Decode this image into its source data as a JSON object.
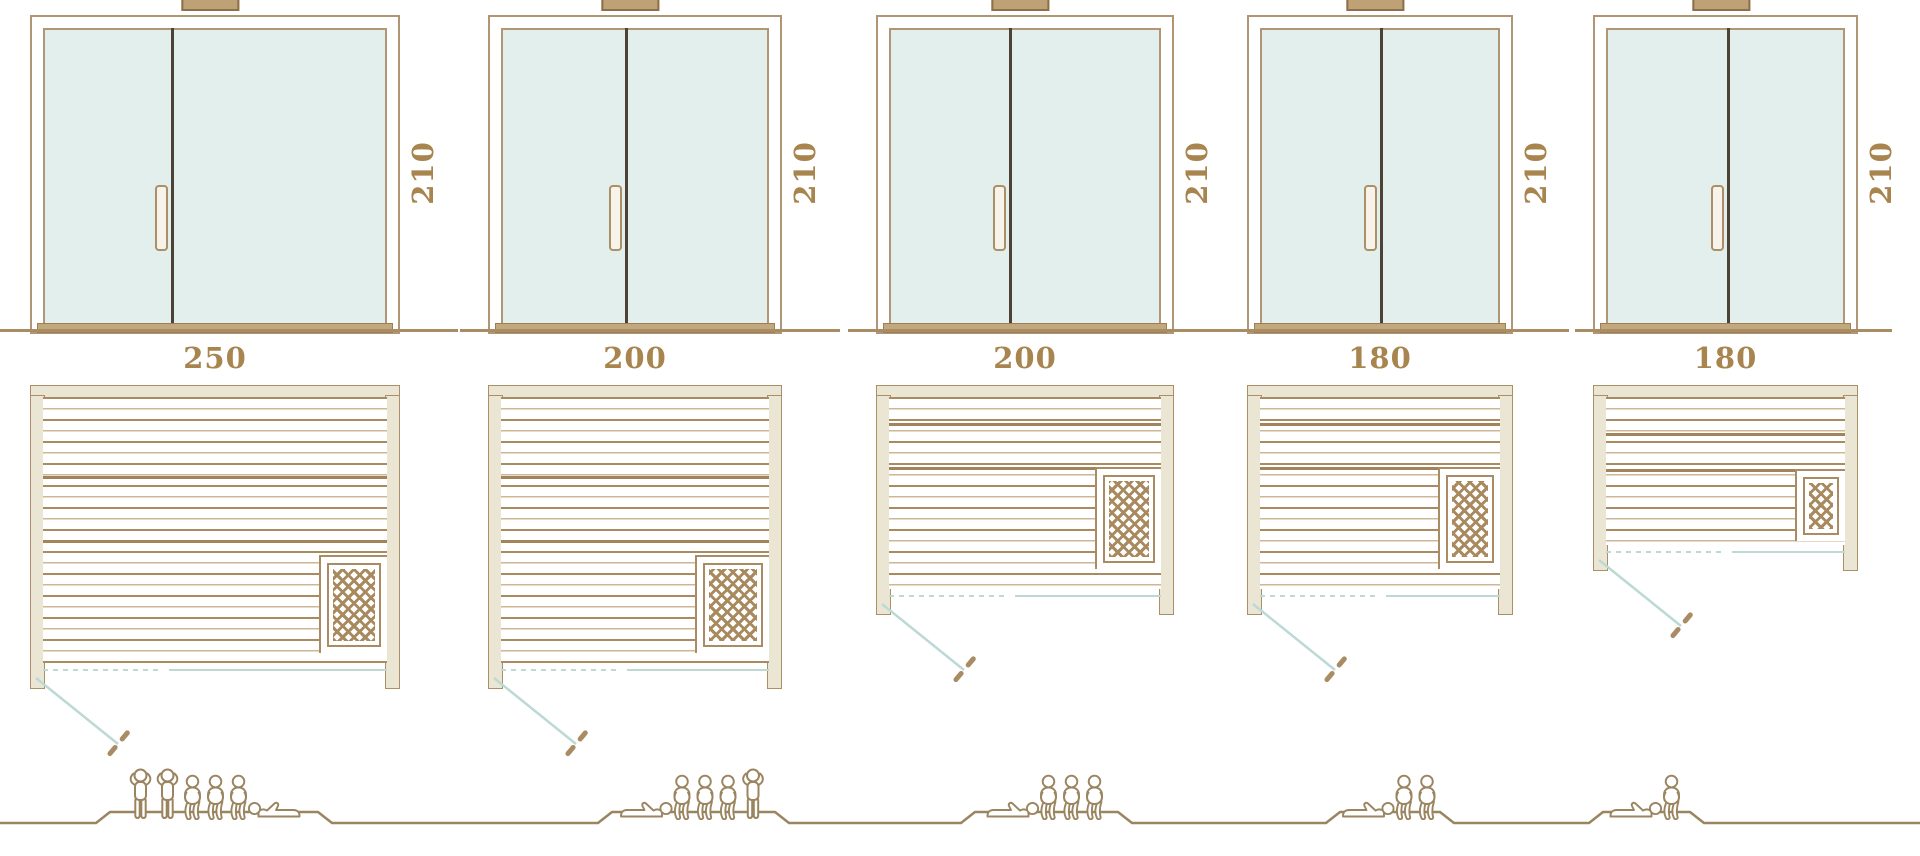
{
  "diagram": {
    "title": "Sauna size comparison — door elevations, floor plans and capacity"
  },
  "colors": {
    "frame_tan": "#b09674",
    "wall_beige": "#eae6d3",
    "glass": "#e2efec",
    "door_divider": "#4c4236",
    "dimension_text": "#a8854e",
    "slat_brown": "#a98b62",
    "swing_teal": "#bcd9d6",
    "figure_brown": "#9b8560"
  },
  "models": [
    {
      "door_height": "210",
      "width": "250",
      "depth": "200",
      "capacity": {
        "standing": 2,
        "sitting": 3,
        "lying": 1
      },
      "people": [
        "standing",
        "standing",
        "sitting",
        "sitting",
        "sitting",
        "lying-right"
      ]
    },
    {
      "door_height": "210",
      "width": "200",
      "depth": "200",
      "capacity": {
        "standing": 1,
        "sitting": 3,
        "lying": 1
      },
      "people": [
        "lying-left",
        "sitting",
        "sitting",
        "sitting",
        "standing"
      ]
    },
    {
      "door_height": "210",
      "width": "200",
      "depth": "150",
      "capacity": {
        "standing": 0,
        "sitting": 3,
        "lying": 1
      },
      "people": [
        "lying-left",
        "sitting",
        "sitting",
        "sitting"
      ]
    },
    {
      "door_height": "210",
      "width": "180",
      "depth": "150",
      "capacity": {
        "standing": 0,
        "sitting": 2,
        "lying": 1
      },
      "people": [
        "lying-left",
        "sitting",
        "sitting"
      ]
    },
    {
      "door_height": "210",
      "width": "180",
      "depth": "120",
      "capacity": {
        "standing": 0,
        "sitting": 1,
        "lying": 1
      },
      "people": [
        "lying-left",
        "sitting"
      ]
    }
  ]
}
